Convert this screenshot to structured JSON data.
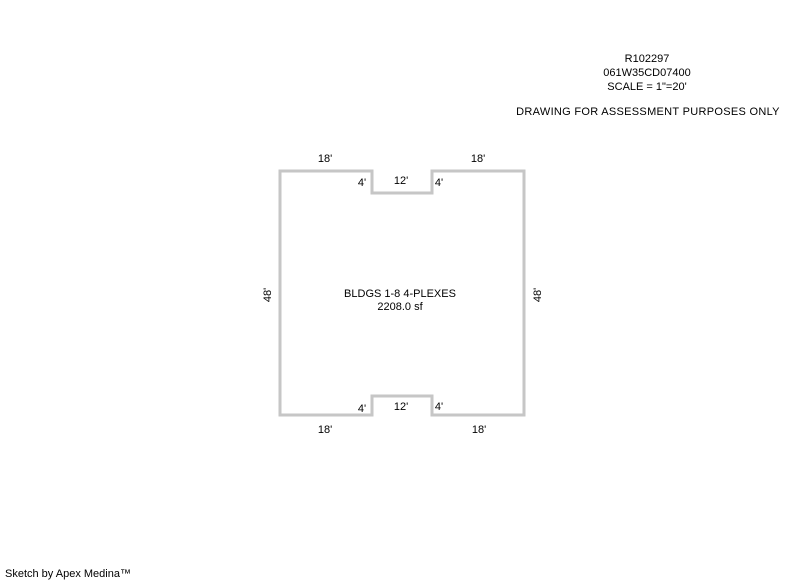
{
  "header": {
    "account_number": "R102297",
    "parcel_id": "061W35CD07400",
    "scale": "SCALE = 1\"=20'",
    "disclaimer": "DRAWING FOR ASSESSMENT PURPOSES ONLY"
  },
  "sketch": {
    "building_label": "BLDGS 1-8 4-PLEXES",
    "building_area": "2208.0 sf",
    "dimensions": {
      "top_left_18": "18'",
      "top_right_18": "18'",
      "top_notch_4_left": "4'",
      "top_notch_12": "12'",
      "top_notch_4_right": "4'",
      "left_48": "48'",
      "right_48": "48'",
      "bottom_notch_4_left": "4'",
      "bottom_notch_12": "12'",
      "bottom_notch_4_right": "4'",
      "bottom_left_18": "18'",
      "bottom_right_18": "18'"
    },
    "colors": {
      "background": "#ffffff",
      "outline": "#c6c6c6",
      "text": "#000000"
    }
  },
  "footer": {
    "credit": "Sketch by Apex Medina™"
  }
}
